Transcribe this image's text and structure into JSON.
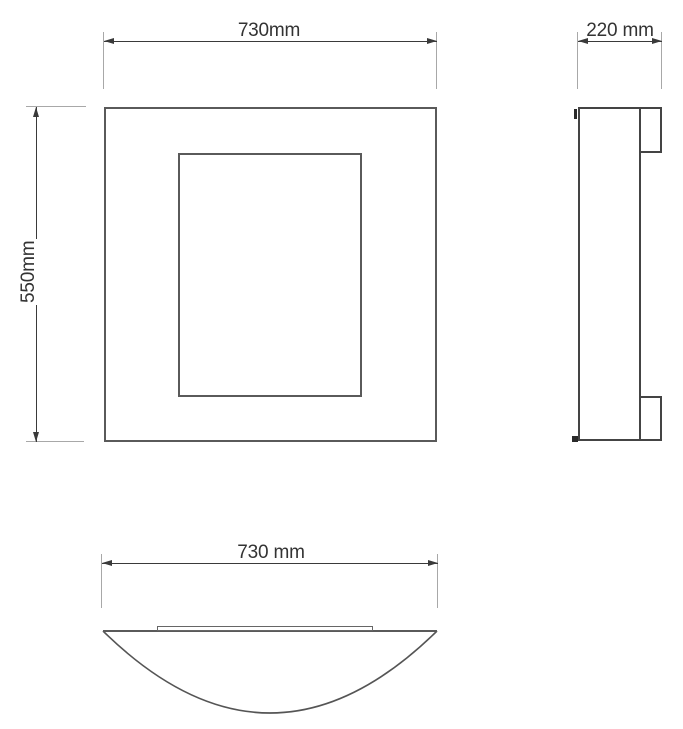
{
  "drawing": {
    "type": "technical-dimension-drawing",
    "views": {
      "front": {
        "name": "front view",
        "width": {
          "label": "730mm",
          "value_mm": 730
        },
        "height": {
          "label": "550mm",
          "value_mm": 550
        }
      },
      "side": {
        "name": "side view",
        "depth": {
          "label": "220 mm",
          "value_mm": 220
        }
      },
      "bottom": {
        "name": "bottom view",
        "width": {
          "label": "730 mm",
          "value_mm": 730
        }
      }
    },
    "colors": {
      "background": "#ffffff",
      "outline": "#5a5a5a",
      "dimension_line": "#3a3a3a",
      "extension_line": "#a8a8a8",
      "text": "#333333"
    }
  }
}
